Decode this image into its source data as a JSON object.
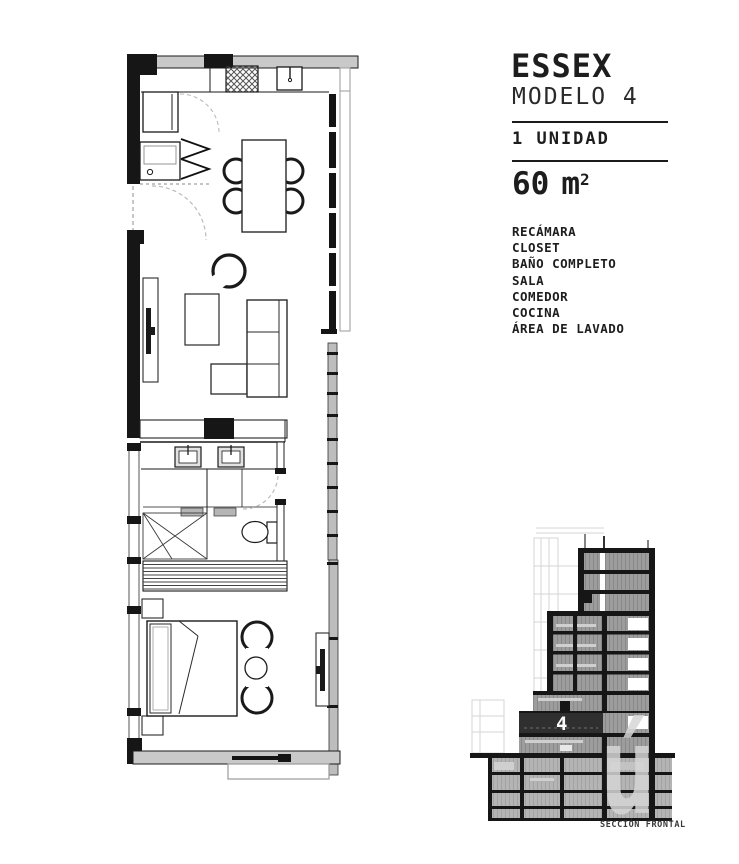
{
  "panel": {
    "title": "ESSEX",
    "subtitle": "MODELO 4",
    "units_label": "1 UNIDAD",
    "area_value": "60",
    "area_unit": "m",
    "area_exponent": "2",
    "features": [
      "RECÁMARA",
      "CLOSET",
      "BAÑO COMPLETO",
      "SALA",
      "COMEDOR",
      "COCINA",
      "ÁREA DE LAVADO"
    ]
  },
  "section": {
    "unit_floor_label": "4",
    "caption": "SECCIÓN FRONTAL",
    "watermark_letter": "ú"
  },
  "colors": {
    "text": "#1d1d1d",
    "wall_gray": "#c9c9c9",
    "section_floor_gray": "#9d9d9d",
    "section_dark_band": "#2f2f2f",
    "watermark_gray": "#d6d6d6"
  }
}
